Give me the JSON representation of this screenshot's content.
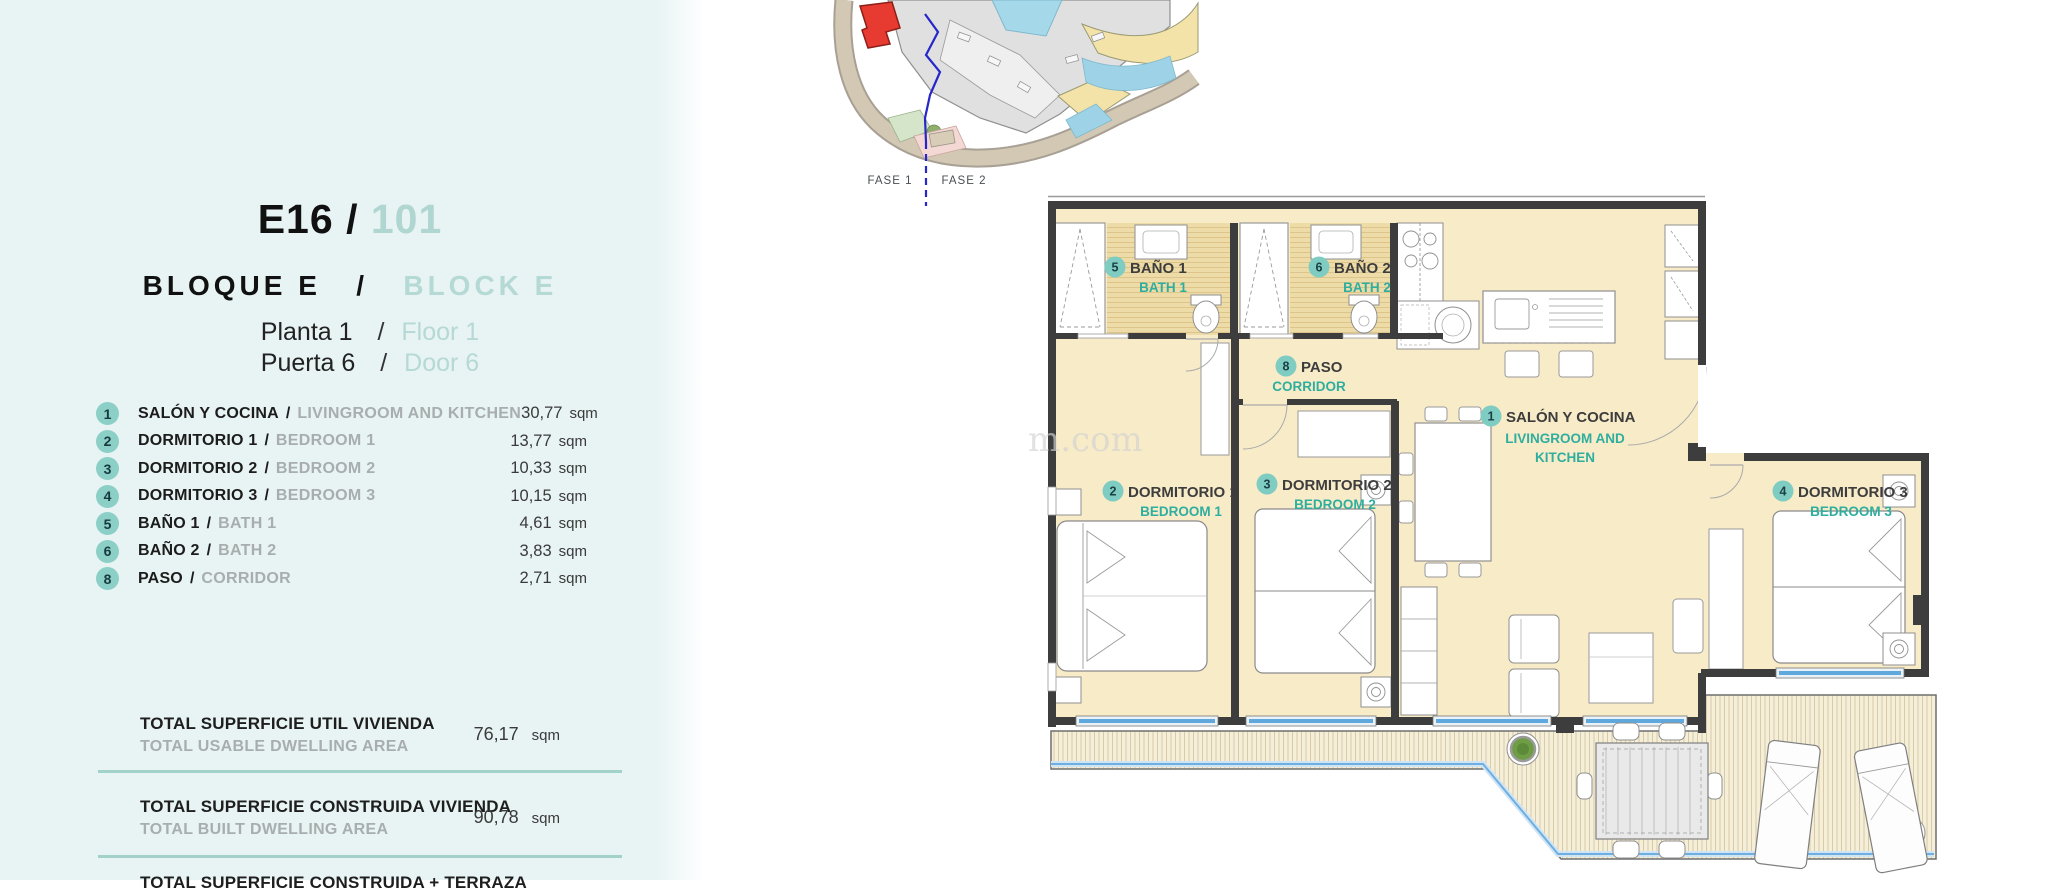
{
  "ui": {
    "slash": "/",
    "sqm": "sqm"
  },
  "unit": {
    "code": "E16",
    "number": "101"
  },
  "block": {
    "es": "BLOQUE E",
    "en": "BLOCK E"
  },
  "floor": {
    "es": "Planta 1",
    "en": "Floor 1"
  },
  "door": {
    "es": "Puerta 6",
    "en": "Door 6"
  },
  "rooms": [
    {
      "num": "1",
      "es": "SALÓN Y COCINA",
      "en": "LIVINGROOM AND KITCHEN",
      "area": "30,77"
    },
    {
      "num": "2",
      "es": "DORMITORIO 1",
      "en": "BEDROOM 1",
      "area": "13,77"
    },
    {
      "num": "3",
      "es": "DORMITORIO 2",
      "en": "BEDROOM 2",
      "area": "10,33"
    },
    {
      "num": "4",
      "es": "DORMITORIO 3",
      "en": "BEDROOM 3",
      "area": "10,15"
    },
    {
      "num": "5",
      "es": "BAÑO 1",
      "en": "BATH 1",
      "area": "4,61"
    },
    {
      "num": "6",
      "es": "BAÑO 2",
      "en": "BATH 2",
      "area": "3,83"
    },
    {
      "num": "8",
      "es": "PASO",
      "en": "CORRIDOR",
      "area": "2,71"
    }
  ],
  "totals": [
    {
      "es": "TOTAL SUPERFICIE UTIL VIVIENDA",
      "en": "TOTAL USABLE DWELLING AREA",
      "value": "76,17"
    },
    {
      "es": "TOTAL SUPERFICIE CONSTRUIDA VIVIENDA",
      "en": "TOTAL BUILT DWELLING AREA",
      "value": "90,78"
    },
    {
      "es": "TOTAL SUPERFICIE CONSTRUIDA + TERRAZA",
      "en": "",
      "value": ""
    }
  ],
  "site_map": {
    "fase1": "FASE 1",
    "fase2": "FASE 2",
    "highlight_color": "#e73a30"
  },
  "plan": {
    "living": {
      "num": "1",
      "es": "SALÓN Y COCINA",
      "en1": "LIVINGROOM AND",
      "en2": "KITCHEN"
    },
    "bed1": {
      "num": "2",
      "es": "DORMITORIO 1",
      "en": "BEDROOM 1"
    },
    "bed2": {
      "num": "3",
      "es": "DORMITORIO 2",
      "en": "BEDROOM 2"
    },
    "bed3": {
      "num": "4",
      "es": "DORMITORIO 3",
      "en": "BEDROOM 3"
    },
    "bath1": {
      "num": "5",
      "es": "BAÑO 1",
      "en": "BATH 1"
    },
    "bath2": {
      "num": "6",
      "es": "BAÑO 2",
      "en": "BATH 2"
    },
    "paso": {
      "num": "8",
      "es": "PASO",
      "en": "CORRIDOR"
    }
  },
  "watermark": "m.com",
  "colors": {
    "panel_bg": "#e8f3f4",
    "accent_teal": "#2fae9f",
    "pale_teal": "#b5d9d4",
    "badge": "#8bcfc6",
    "floor_beige": "#f8ebc8",
    "bath_tan": "#eedca8",
    "deck": "#f5eed8",
    "window_blue": "#5fa8dd",
    "wall": "#3d3d3d",
    "planter_green": "#6f9d45",
    "highlight_red": "#e73a30"
  }
}
